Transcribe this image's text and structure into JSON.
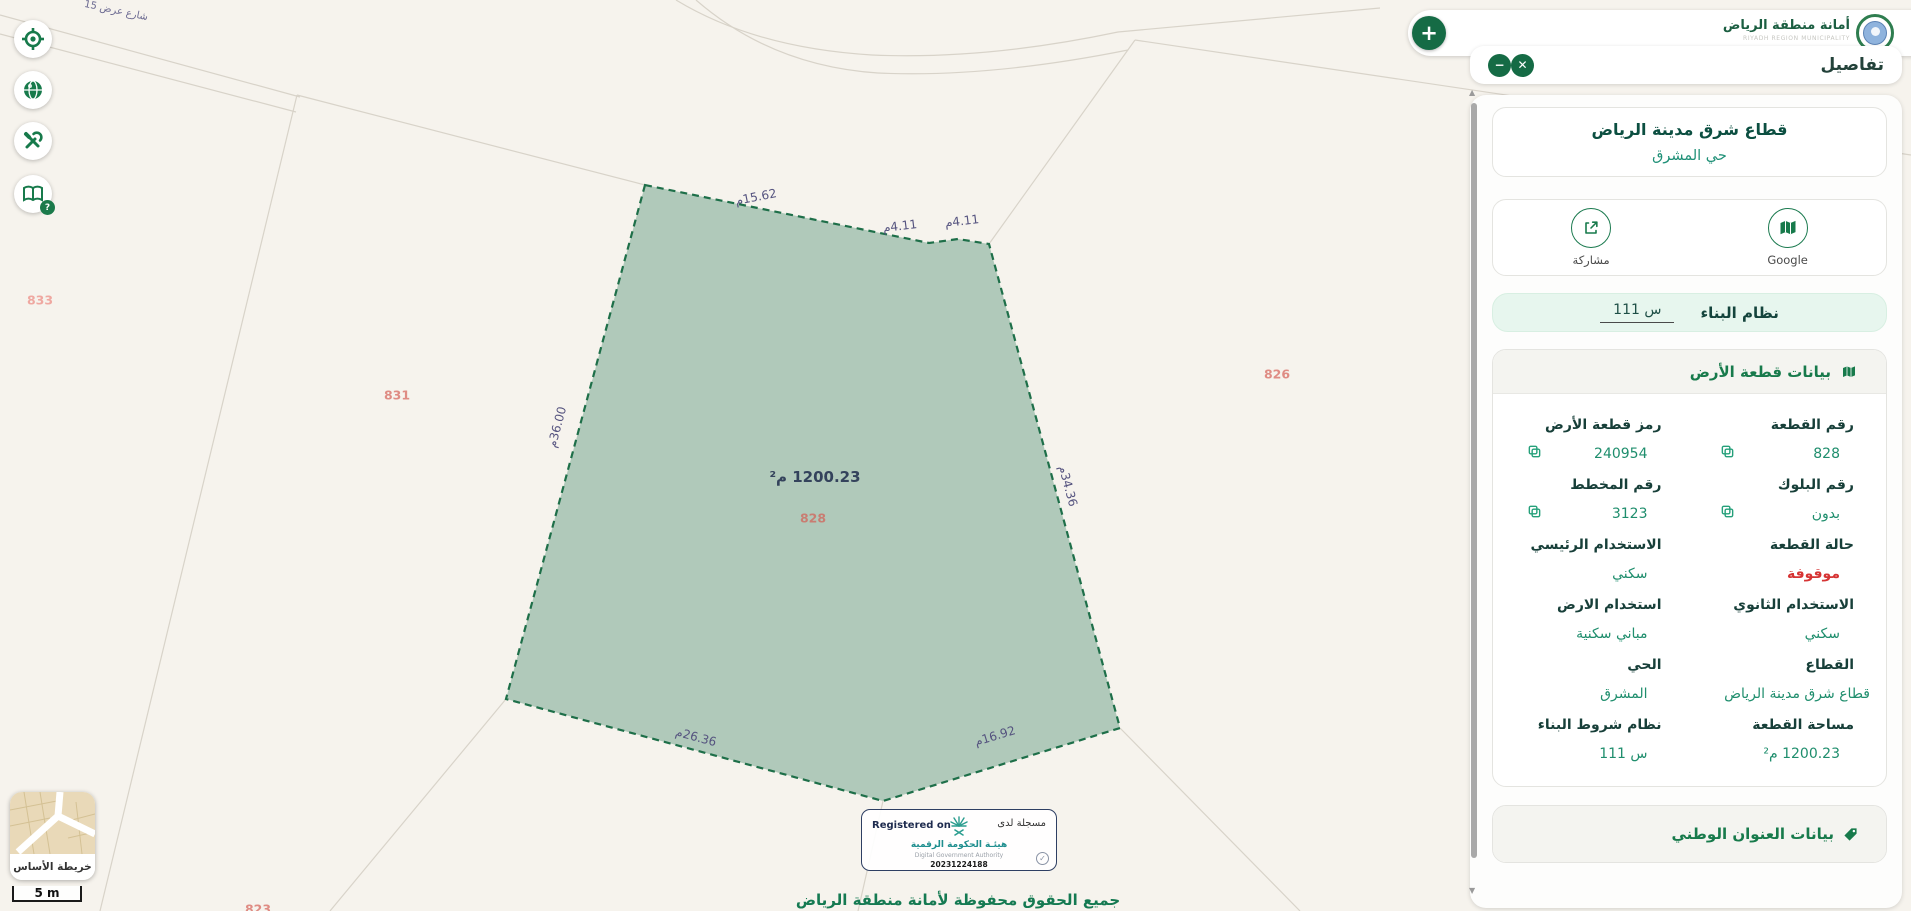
{
  "map": {
    "street": "شارع عرض 15",
    "area": "1200.23 م²",
    "parcels": {
      "center": "828",
      "left": "831",
      "far_left": "833",
      "right": "826",
      "bottom_cut": "823"
    },
    "dims": {
      "top": "15.62م",
      "top_right_1": "4.11م",
      "top_right_2": "4.11م",
      "left": "36.00م",
      "right": "34.36م",
      "bottom_left": "26.36م",
      "bottom_right": "16.92م"
    },
    "basemap_label": "خريطة الأساس",
    "scale": "5 m"
  },
  "header": {
    "logo_ar": "أمانة منطقة الرياض",
    "logo_en": "RIYADH REGION MUNICIPALITY",
    "plus_glyph": "+"
  },
  "badge": {
    "registered_en": "Registered on",
    "registered_ar": "مسجلة لدى",
    "authority_ar": "هيئـة الحكومة الرقمية",
    "authority_en": "Digital Government Authority",
    "reg_number": "20231224188",
    "check_glyph": "✓"
  },
  "copyright": "جميع الحقوق محفوظة لأمانة منطقة الرياض",
  "panel": {
    "header_title": "تفاصيل",
    "close_glyph": "✕",
    "minimize_glyph": "−",
    "sector_title": "قطاع شرق مدينة الرياض",
    "district": "حي المشرق",
    "share_label": "مشاركة",
    "google_label": "Google",
    "building_system_label": "نظام البناء",
    "building_system_value": "س 111",
    "land_section_title": "بيانات قطعة الأرض",
    "address_section_title": "بيانات العنوان الوطني",
    "fields": [
      {
        "label": "رقم القطعة",
        "value": "828",
        "copy": true
      },
      {
        "label": "رمز قطعة الأرض",
        "value": "240954",
        "copy": true
      },
      {
        "label": "رقم البلوك",
        "value": "بدون",
        "copy": true
      },
      {
        "label": "رقم المخطط",
        "value": "3123",
        "copy": true
      },
      {
        "label": "حالة القطعة",
        "value": "موقوفة",
        "status": "red"
      },
      {
        "label": "الاستخدام الرئيسي",
        "value": "سكني"
      },
      {
        "label": "الاستخدام الثانوي",
        "value": "سكني"
      },
      {
        "label": "استخدام الارض",
        "value": "مباني سكنية"
      },
      {
        "label": "القطاع",
        "value": "قطاع شرق مدينة الرياض"
      },
      {
        "label": "الحي",
        "value": "المشرق"
      },
      {
        "label": "مساحة القطعة",
        "value": "1200.23 م²"
      },
      {
        "label": "نظام شروط البناء",
        "value": "س 111"
      }
    ]
  },
  "colors": {
    "primary_green": "#177a4b",
    "value_teal": "#1f8e6d",
    "status_red": "#d63434",
    "parcel_fill": "#a9c5b5",
    "parcel_stroke": "#1e6f49",
    "dim_label": "#55537f",
    "parcel_number": "#df8c84"
  }
}
